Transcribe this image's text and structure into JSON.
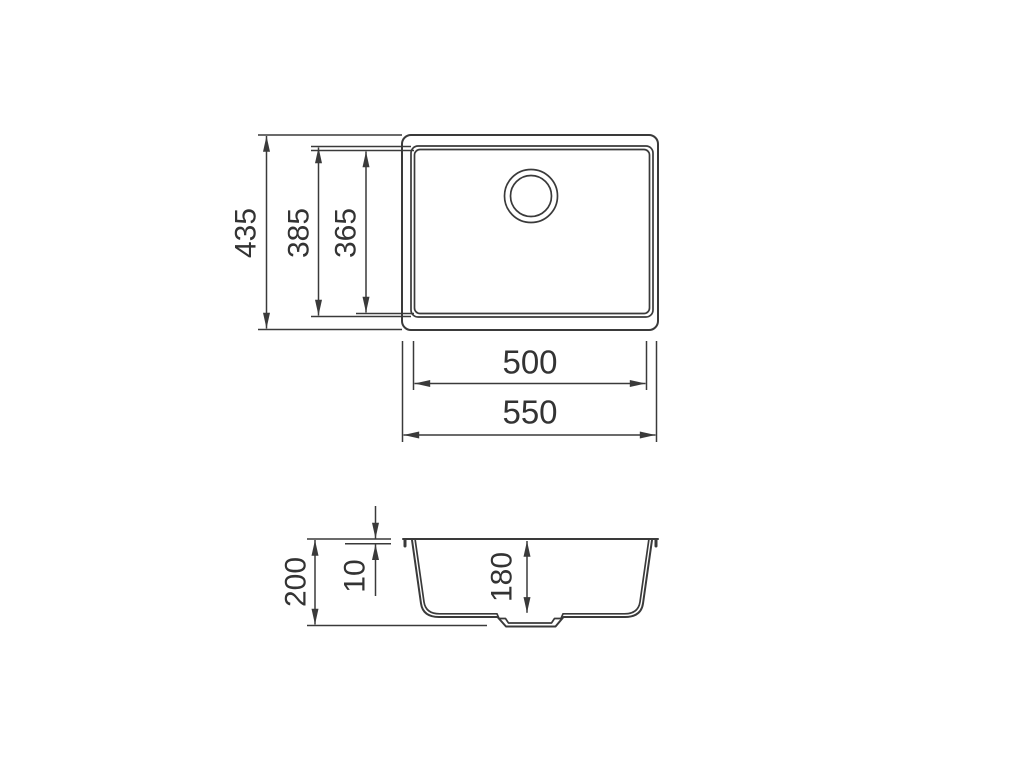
{
  "colors": {
    "background": "#ffffff",
    "line": "#3a3a3a",
    "text": "#333333"
  },
  "drawing": {
    "top_view": {
      "labels": {
        "overall_height": "435",
        "rim_height": "385",
        "bowl_height": "365",
        "bowl_width": "500",
        "overall_width": "550"
      }
    },
    "side_view": {
      "labels": {
        "overall_depth": "200",
        "rim_thickness": "10",
        "bowl_depth": "180"
      }
    }
  }
}
